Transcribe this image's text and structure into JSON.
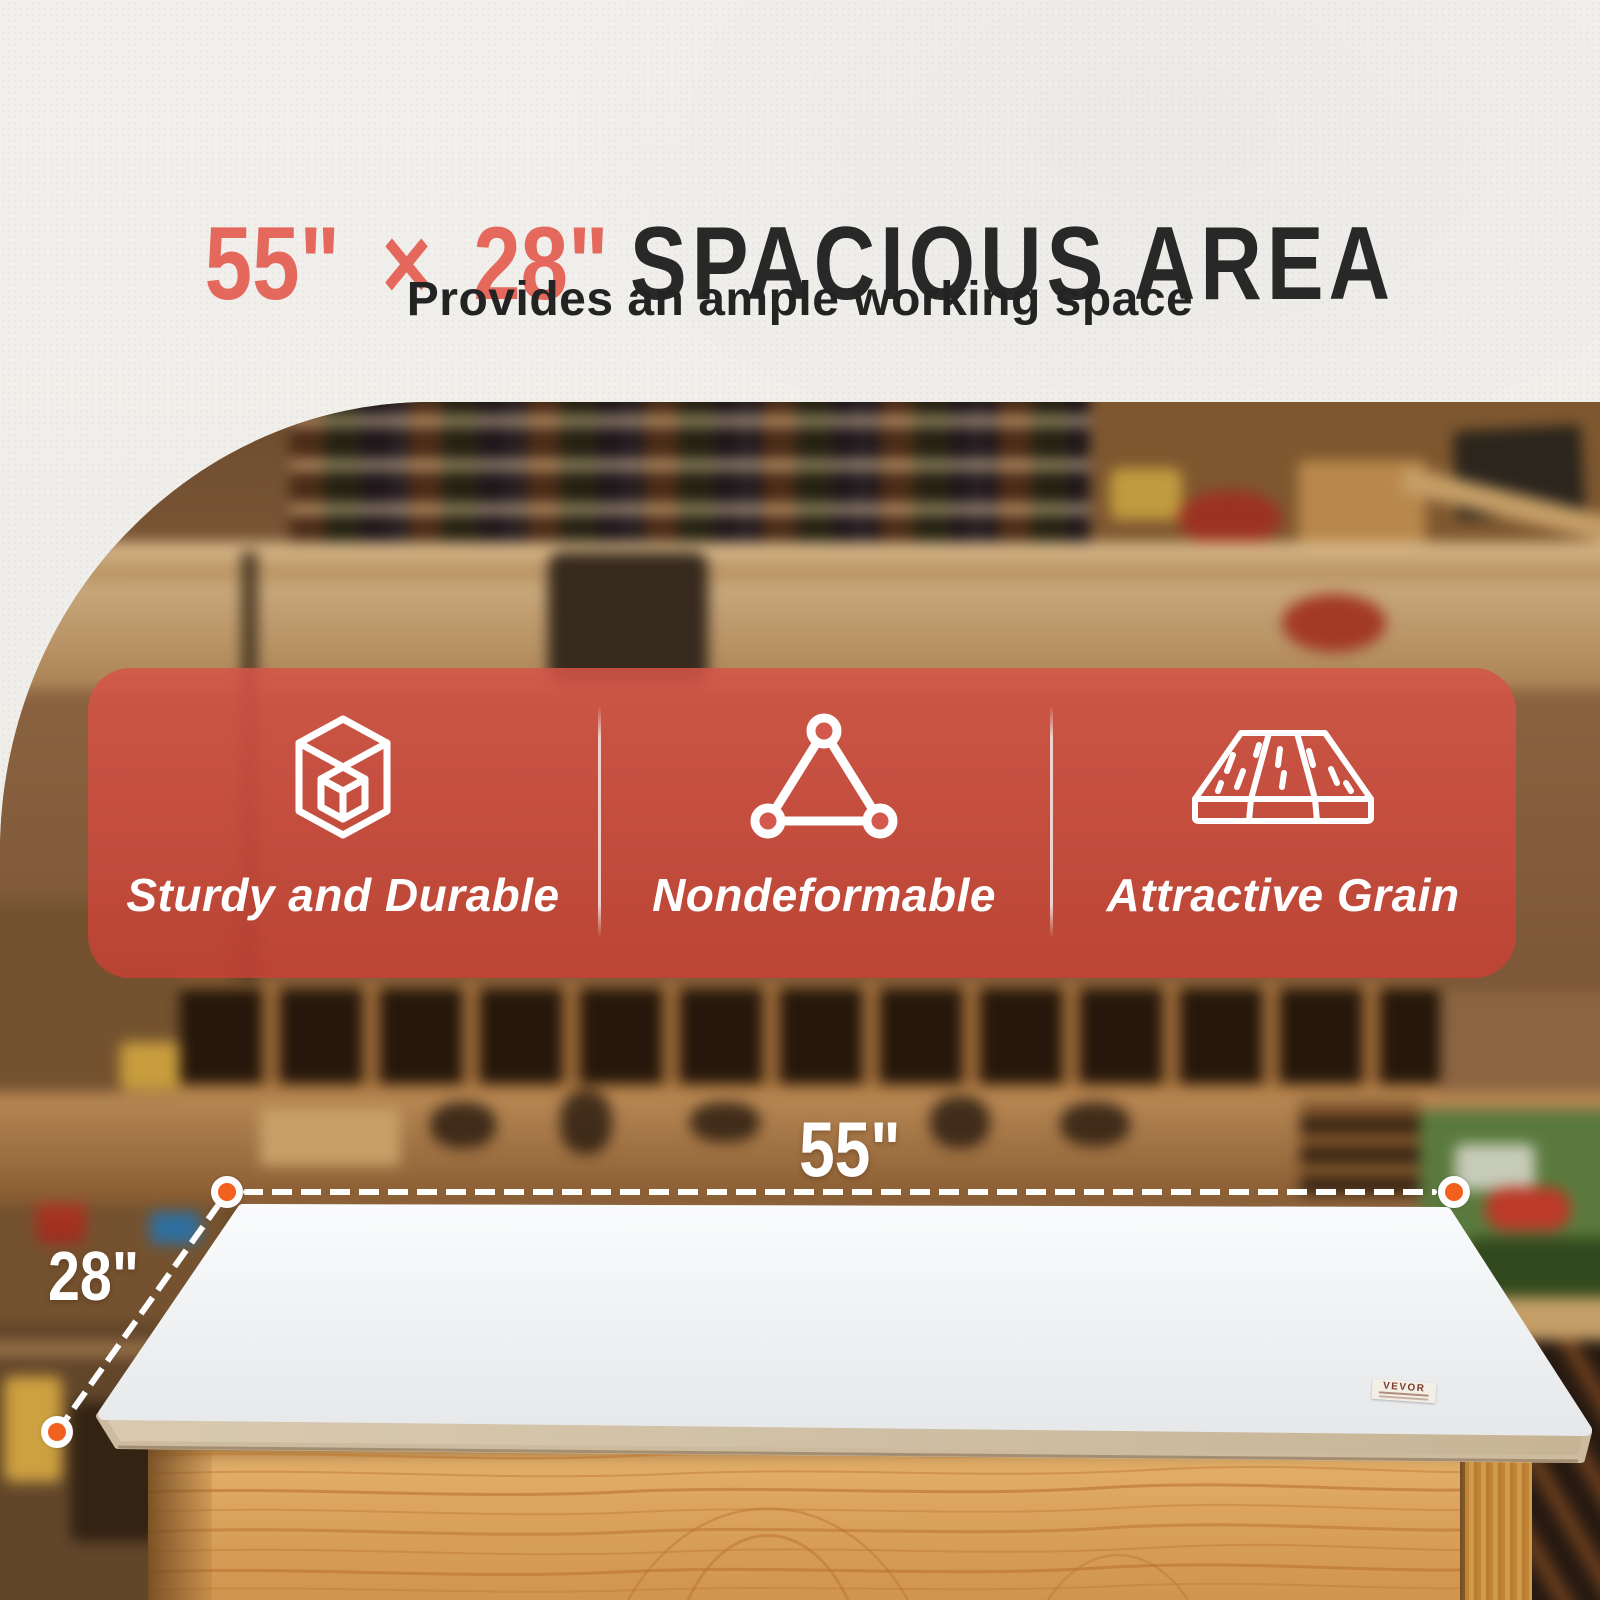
{
  "title": {
    "highlight": "55\" × 28\"",
    "main": "SPACIOUS AREA"
  },
  "subtitle": "Provides an ample working space",
  "feature_banner": {
    "items": [
      {
        "icon": "cube-frame-icon",
        "label": "Sturdy and Durable"
      },
      {
        "icon": "triangle-nodes-icon",
        "label": "Nondeformable"
      },
      {
        "icon": "wood-planks-icon",
        "label": "Attractive Grain"
      }
    ]
  },
  "dimension_callouts": {
    "width": "55\"",
    "depth": "28\""
  },
  "brand_sticker": {
    "text": "VEVOR"
  },
  "colors": {
    "accent_coral": "#e4695c",
    "banner_red": "#d24638",
    "marker_orange": "#f2601d",
    "heading_dark": "#282828",
    "pine_wood": "#dca45e",
    "tabletop_white": "#f4f5f6"
  }
}
